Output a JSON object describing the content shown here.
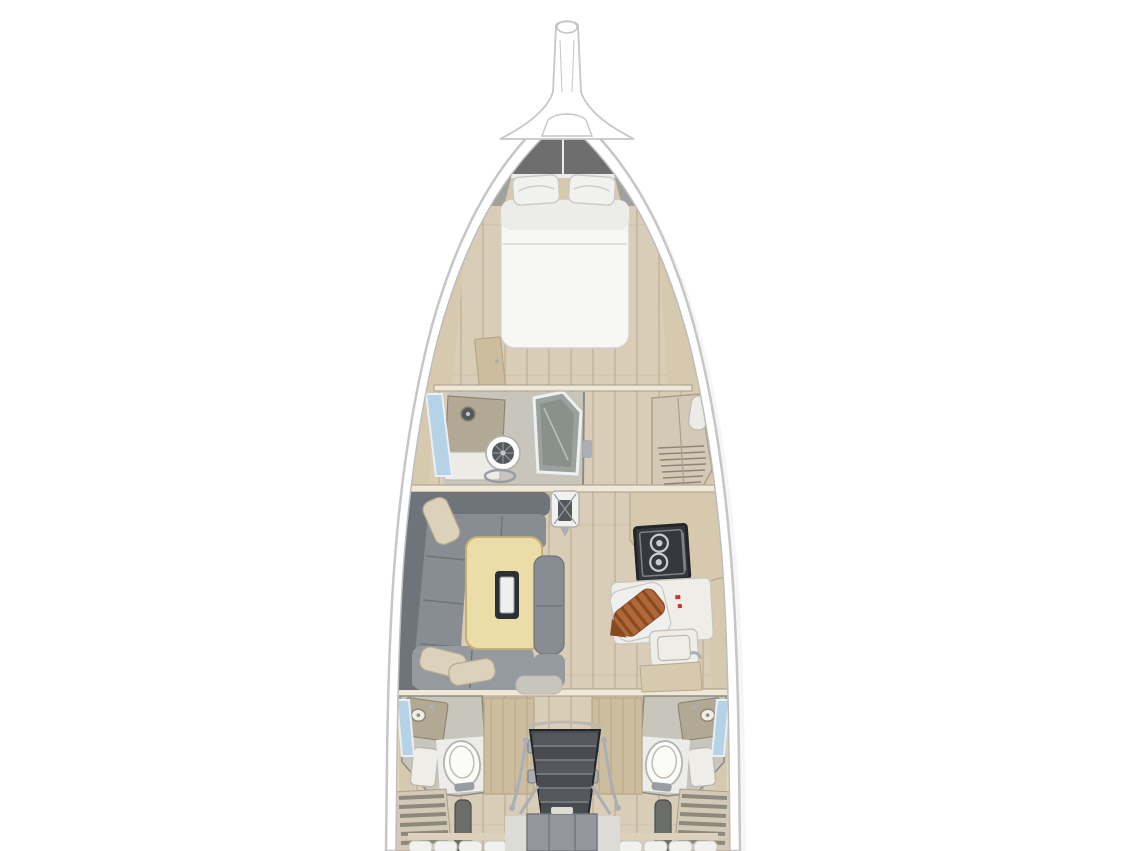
{
  "meta": {
    "title": "Sailing yacht interior layout plan",
    "view": "top-down cutaway floor plan",
    "visible_text": "none"
  },
  "palette": {
    "page_bg": "#ffffff",
    "hull_white": "#ffffff",
    "hull_stroke": "#c6c6c6",
    "inner_stroke": "#bdbdbd",
    "shadow": "#ededed",
    "bow_deck": "#ececec",
    "anchor_locker": "#6e6e6e",
    "bow_wedge": "#9a9a9a",
    "cream": "#d6c9ad",
    "trim": "#e7dabb",
    "bulkhead": "#efe8d7",
    "bulkhead_line": "#a69d8d",
    "floor": "#d9cdb7",
    "floor_line": "#c0b197",
    "mattress": "#f7f7f5",
    "mattress_shade": "#ececea",
    "mattress_stroke": "#d2d2d0",
    "pillow": "#f1f1ef",
    "pillow_line": "#c9c9c7",
    "sofa": "#878d92",
    "sofa_dark": "#6e7479",
    "sofa_light": "#949aa0",
    "cushion": "#dcd2bc",
    "cushion_line": "#b5aa8f",
    "table": "#ecdca8",
    "table_edge": "#c6ae74",
    "slot_dark": "#2c2f34",
    "slot_light": "#eef0f0",
    "glass": "#9ba19d",
    "glass_dark": "#8a908c",
    "glass_frame": "#eef1f2",
    "head_floor": "#c8c5bd",
    "counter_gray": "#b2a995",
    "counter_gray_stroke": "#8f8672",
    "cabinet_white": "#ecebe6",
    "cabinet_stroke": "#bcb9b1",
    "toilet": "#fbfbfa",
    "toilet_stroke": "#b3b3ae",
    "bowl": "#54585c",
    "bowl_line": "#979da2",
    "window": "#b6d2e7",
    "window_frame": "#e9f0f5",
    "wardrobe": "#d3c9b6",
    "wardrobe_stroke": "#a99f8c",
    "slat": "#8e8678",
    "stove_well": "#35393e",
    "stove_stroke": "#222529",
    "burner": "#c7ccd1",
    "counter_white": "#efede8",
    "counter_white_stroke": "#c9c6bf",
    "copper": "#b0683a",
    "copper_dark": "#8a4a20",
    "red_accent": "#c5372a",
    "chrome": "#a9afb5",
    "wall": "#8b8b85",
    "door_wood": "#cdbd9f",
    "door_grain": "#b7a584",
    "step": "#54585d",
    "step_edge": "#7e838a",
    "step_dark": "#484c51",
    "engine": "#94979b",
    "engine_line": "#74787c",
    "engine_light": "#dcdbd6",
    "locker_slat": "#8d897e",
    "vent": "#6a6d68"
  },
  "boat": {
    "sections": [
      {
        "id": "bow",
        "name": "Bow",
        "items": [
          "bowsprit with anchor roller",
          "anchor locker hatch"
        ]
      },
      {
        "id": "forward-cabin",
        "name": "Forward cabin",
        "items": [
          "V-berth double bed",
          "two pillows",
          "side shelves",
          "cabin door"
        ]
      },
      {
        "id": "forward-head",
        "name": "Forward head (port)",
        "items": [
          "vanity with round sink",
          "marine toilet",
          "separate shower stall with glass door",
          "hull window"
        ]
      },
      {
        "id": "forward-wardrobe",
        "name": "Starboard wardrobe / locker",
        "items": [
          "louvered locker front",
          "shelf"
        ]
      },
      {
        "id": "salon",
        "name": "Salon",
        "items": [
          "L-shaped gray settee",
          "beige throw pillows",
          "folding dining table with centerboard trunk",
          "aft-facing bench",
          "mast compression post"
        ]
      },
      {
        "id": "galley",
        "name": "Galley (starboard)",
        "items": [
          "two-burner gimbaled stove",
          "sink with faucet",
          "white worktop",
          "copper bottle rack",
          "red accent marks"
        ]
      },
      {
        "id": "aft-head-port",
        "name": "Aft head (port)",
        "items": [
          "toilet",
          "vanity sink",
          "shower tray",
          "hull window",
          "wood door with hinges",
          "louvered locker"
        ]
      },
      {
        "id": "aft-head-starboard",
        "name": "Aft head (starboard)",
        "items": [
          "toilet",
          "vanity sink",
          "shower tray",
          "hull window",
          "wood door with hinges",
          "louvered locker"
        ]
      },
      {
        "id": "companionway",
        "name": "Companionway",
        "items": [
          "companionway steps",
          "chrome handrails"
        ]
      },
      {
        "id": "engine",
        "name": "Engine compartment",
        "items": [
          "engine box under steps"
        ]
      },
      {
        "id": "aft-berths",
        "name": "Aft berths (partially visible)",
        "items": [
          "tufted white mattress edges at image bottom"
        ]
      }
    ]
  }
}
